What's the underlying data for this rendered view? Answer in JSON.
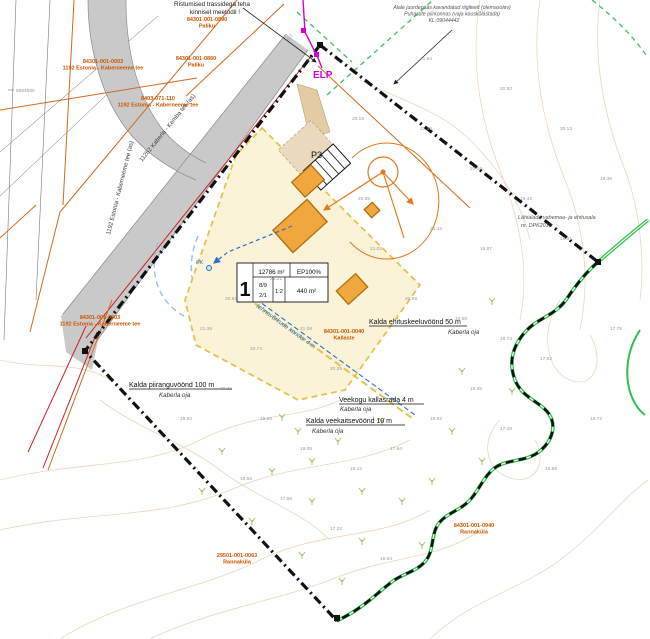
{
  "map": {
    "kind": "detailplaneering site plan (cadastral base map)"
  },
  "notes": {
    "crossing": {
      "line1": "Ristumised trassidega teha",
      "line2": "kinnisel meetodil !"
    },
    "access": {
      "line1": "Alale juurdepääs kavandatud riigiteelt (olemasolev)",
      "line2": "Puhastite piirkonnas (vaja kooskõlastada)",
      "line3": "KL:09044442"
    },
    "east": {
      "line1": "Lähialade vahemaa- ja ehitusala",
      "line2": "nr. DPK2010"
    }
  },
  "zones": {
    "keeluvoond": {
      "label": "Kalda ehituskeeluvöönd 50 m",
      "stream": "Kaberla oja"
    },
    "kallasrada": {
      "label": "Veekogu kallasrada 4 m",
      "stream": "Kaberla oja"
    },
    "veekaitse": {
      "label": "Kalda veekaitsevöönd 10 m",
      "stream": "Kaberla oja"
    },
    "piirang": {
      "label": "Kalda piiranguvöönd 100 m",
      "stream": "Kaberla oja"
    }
  },
  "labels": {
    "elp": "ELP",
    "p3": "P3",
    "pk": "PK",
    "corridor": "tehnovõrkude koridor 4 m",
    "grid": "6584500"
  },
  "roads": {
    "branch": "1192 Estonia - Kaberneeme tee (as)",
    "main": "11262 Kaberla - Kemba tee (as)"
  },
  "plot": {
    "number": "1",
    "area": "12786 m²",
    "intensity": "EP100%",
    "storeys": "8/9",
    "units": "2/1",
    "ratio": "1:2",
    "building_area": "440 m²"
  },
  "cadastral_labels": [
    {
      "x": 207,
      "y": 21,
      "code": "84301-001-0890",
      "name": "Paliku"
    },
    {
      "x": 196,
      "y": 60,
      "code": "84301-001-0860",
      "name": "Paliku"
    },
    {
      "x": 103,
      "y": 63,
      "code": "84301-001-0003",
      "name": "1192 Estonia - Kaberneeme tee"
    },
    {
      "x": 158,
      "y": 100,
      "code": "8403-071-110",
      "name": "1192 Estonia - Kaberneeme tee"
    },
    {
      "x": 100,
      "y": 319,
      "code": "84301-001-0003",
      "name": "1192 Estonia - Kaberneeme tee"
    },
    {
      "x": 344,
      "y": 333,
      "code": "84301-001-0040",
      "name": "Kallaste"
    },
    {
      "x": 474,
      "y": 527,
      "code": "84301-001-0940",
      "name": "Rannaküla"
    },
    {
      "x": 237,
      "y": 557,
      "code": "29501-001-0063",
      "name": "Rannaküla"
    }
  ],
  "elevation_marks": [
    {
      "x": 289,
      "y": 41,
      "v": "0,7",
      "r": -50
    },
    {
      "x": 352,
      "y": 120,
      "v": "20.18"
    },
    {
      "x": 420,
      "y": 130,
      "v": "21.35"
    },
    {
      "x": 470,
      "y": 170,
      "v": "20.06"
    },
    {
      "x": 520,
      "y": 200,
      "v": "19.42"
    },
    {
      "x": 560,
      "y": 240,
      "v": "18.91"
    },
    {
      "x": 480,
      "y": 250,
      "v": "19.87"
    },
    {
      "x": 430,
      "y": 230,
      "v": "20.44"
    },
    {
      "x": 370,
      "y": 250,
      "v": "21.02"
    },
    {
      "x": 405,
      "y": 300,
      "v": "20.66"
    },
    {
      "x": 455,
      "y": 320,
      "v": "19.58"
    },
    {
      "x": 500,
      "y": 340,
      "v": "18.74"
    },
    {
      "x": 540,
      "y": 360,
      "v": "17.92"
    },
    {
      "x": 470,
      "y": 390,
      "v": "18.35"
    },
    {
      "x": 430,
      "y": 420,
      "v": "18.02"
    },
    {
      "x": 390,
      "y": 450,
      "v": "17.64"
    },
    {
      "x": 350,
      "y": 470,
      "v": "18.12"
    },
    {
      "x": 300,
      "y": 450,
      "v": "19.05"
    },
    {
      "x": 260,
      "y": 420,
      "v": "19.66"
    },
    {
      "x": 220,
      "y": 390,
      "v": "20.21"
    },
    {
      "x": 250,
      "y": 350,
      "v": "20.74"
    },
    {
      "x": 300,
      "y": 330,
      "v": "21.08"
    },
    {
      "x": 330,
      "y": 370,
      "v": "20.35"
    },
    {
      "x": 200,
      "y": 330,
      "v": "21.36"
    },
    {
      "x": 180,
      "y": 420,
      "v": "19.92"
    },
    {
      "x": 280,
      "y": 500,
      "v": "17.85"
    },
    {
      "x": 330,
      "y": 530,
      "v": "17.22"
    },
    {
      "x": 380,
      "y": 560,
      "v": "16.94"
    },
    {
      "x": 240,
      "y": 480,
      "v": "18.56"
    },
    {
      "x": 500,
      "y": 430,
      "v": "17.48"
    },
    {
      "x": 545,
      "y": 470,
      "v": "16.89"
    },
    {
      "x": 420,
      "y": 60,
      "v": "21.64"
    },
    {
      "x": 500,
      "y": 90,
      "v": "20.92"
    },
    {
      "x": 560,
      "y": 130,
      "v": "20.13"
    },
    {
      "x": 600,
      "y": 180,
      "v": "19.35"
    },
    {
      "x": 610,
      "y": 330,
      "v": "17.75"
    },
    {
      "x": 590,
      "y": 420,
      "v": "16.72"
    },
    {
      "x": 358,
      "y": 200,
      "v": "20.85"
    },
    {
      "x": 225,
      "y": 300,
      "v": "20.92"
    },
    {
      "x": 270,
      "y": 280,
      "v": "21.21"
    }
  ],
  "colors": {
    "boundary": "#111111",
    "building_fill": "#f0a73e",
    "building_edge": "#a86f10",
    "building_area_fill": "#fbf3d8",
    "building_area_edge": "#e3c34b",
    "cadastral_text": "#cc5500",
    "river_green": "#2ebf4f",
    "utility_magenta": "#d400d4",
    "road_fill": "#c9c9c9",
    "contour_tan": "#d9b588",
    "water_blue": "#2f6fc4",
    "red_line": "#cc2020"
  }
}
